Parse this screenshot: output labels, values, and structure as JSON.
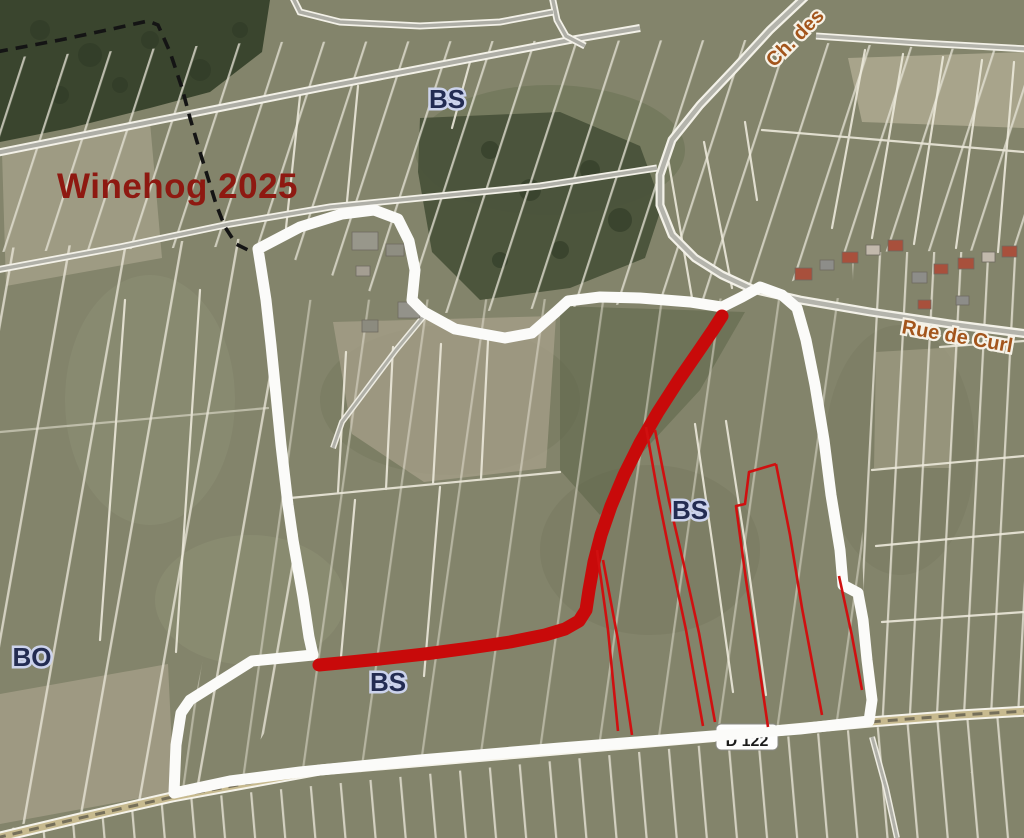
{
  "map": {
    "watermark": {
      "text": "Winehog 2025",
      "color": "#8e1911"
    },
    "parcel_labels": [
      {
        "id": "bs-top",
        "text": "BS"
      },
      {
        "id": "bs-center",
        "text": "BS"
      },
      {
        "id": "bs-lower",
        "text": "BS"
      },
      {
        "id": "bo-west",
        "text": "BO"
      }
    ],
    "road_labels": [
      {
        "id": "ch-des",
        "text": "Ch. des"
      },
      {
        "id": "rue-de-curl",
        "text": "Rue de Curl"
      }
    ],
    "road_shield": {
      "text": "D 122"
    },
    "colors": {
      "route_red": "#c80a0a",
      "parcel_outline_red": "#d01010",
      "boundary_white": "#fbfbf9",
      "watermark_red": "#8e1911",
      "parcel_label_navy": "#232c52",
      "road_label_brown": "#a3551c",
      "field_base": "#83846b",
      "forest_dark": "#3a452e"
    }
  }
}
